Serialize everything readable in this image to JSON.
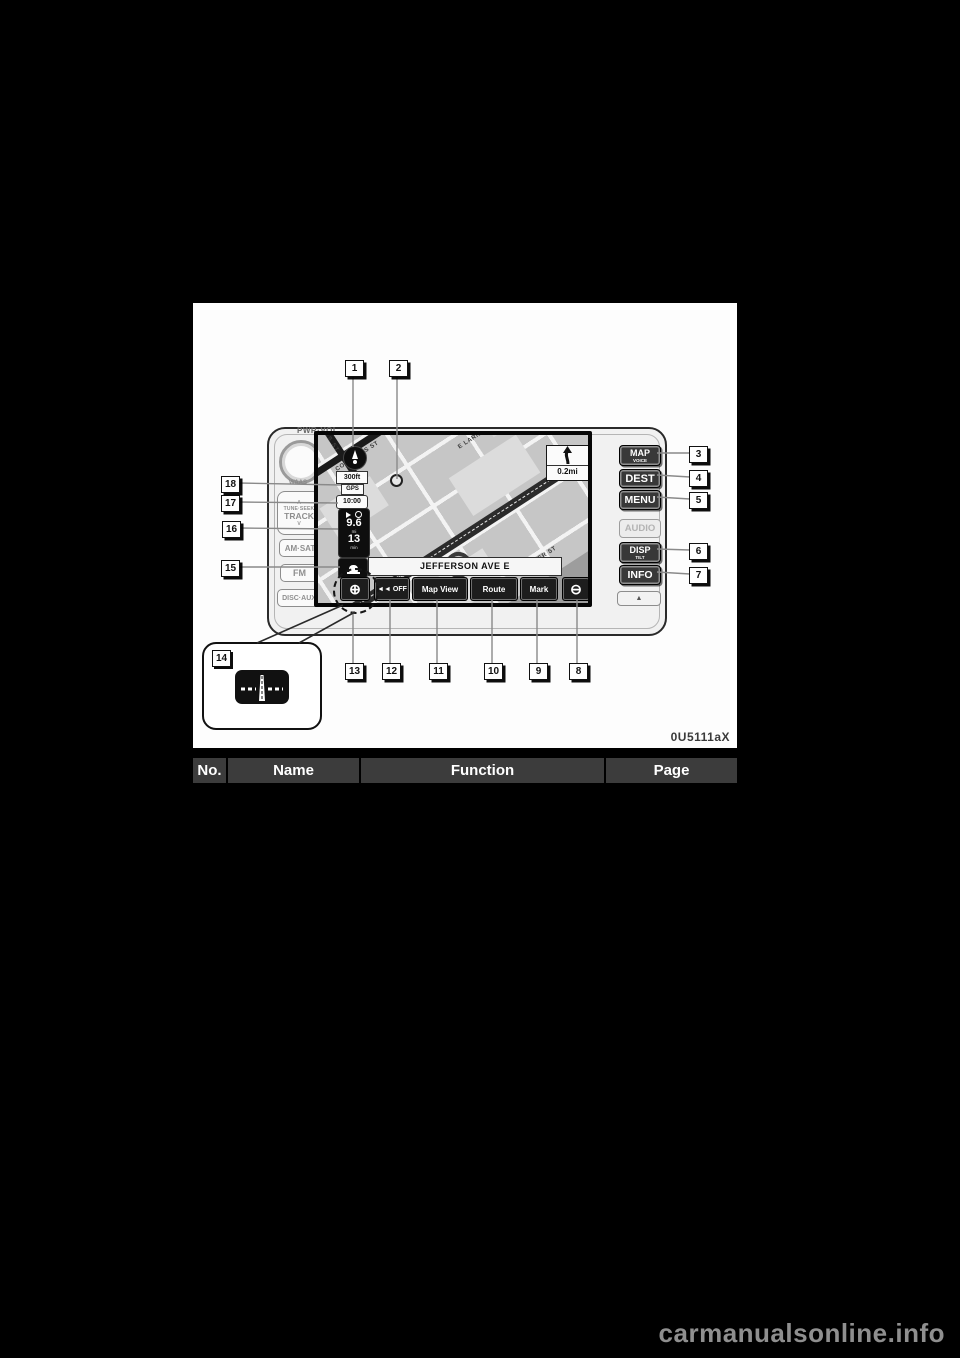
{
  "page": {
    "image_code": "0U5111aX",
    "watermark": "carmanualsonline.info"
  },
  "table": {
    "headers": [
      "No.",
      "Name",
      "Function",
      "Page"
    ]
  },
  "callouts": [
    "1",
    "2",
    "3",
    "4",
    "5",
    "6",
    "7",
    "8",
    "9",
    "10",
    "11",
    "12",
    "13",
    "14",
    "15",
    "16",
    "17",
    "18"
  ],
  "device": {
    "volume_knob_label": "PWR·VOL",
    "waas_label": "WAAS",
    "left_panel": {
      "up_arrow": "∧",
      "tune_seek": "TUNE·SEEK",
      "track": "TRACK",
      "down_arrow": "∨",
      "am_sat": "AM·SAT",
      "fm": "FM",
      "disc_aux": "DISC·AUX"
    },
    "right_panel": {
      "map": "MAP",
      "map_sub": "VOICE",
      "dest": "DEST",
      "menu": "MENU",
      "audio": "AUDIO",
      "disp": "DISP",
      "disp_sub": "TILT",
      "info": "INFO",
      "eject_icon": "▲"
    }
  },
  "screen": {
    "scale": "300ft",
    "gps_label": "GPS",
    "clock": "10:00",
    "trip_info": {
      "distance": "9.6",
      "distance_unit": "mi",
      "time": "13",
      "time_unit": "min"
    },
    "street_banner": "JEFFERSON AVE E",
    "turn_guidance": {
      "distance": "0.2mi"
    },
    "touch_buttons": {
      "off": "◄◄ OFF",
      "map_view": "Map View",
      "route": "Route",
      "mark": "Mark",
      "zoom_in": "⊕",
      "zoom_out": "⊖"
    },
    "streets": {
      "shelby": "SHELBY",
      "bates": "BATES ST",
      "congress": "CONGRESS ST",
      "e_larned": "E LARNED",
      "larned": "LARNED ST",
      "atwater": "ATWATER ST",
      "jefferson": "JEFFERSON AVE"
    }
  }
}
